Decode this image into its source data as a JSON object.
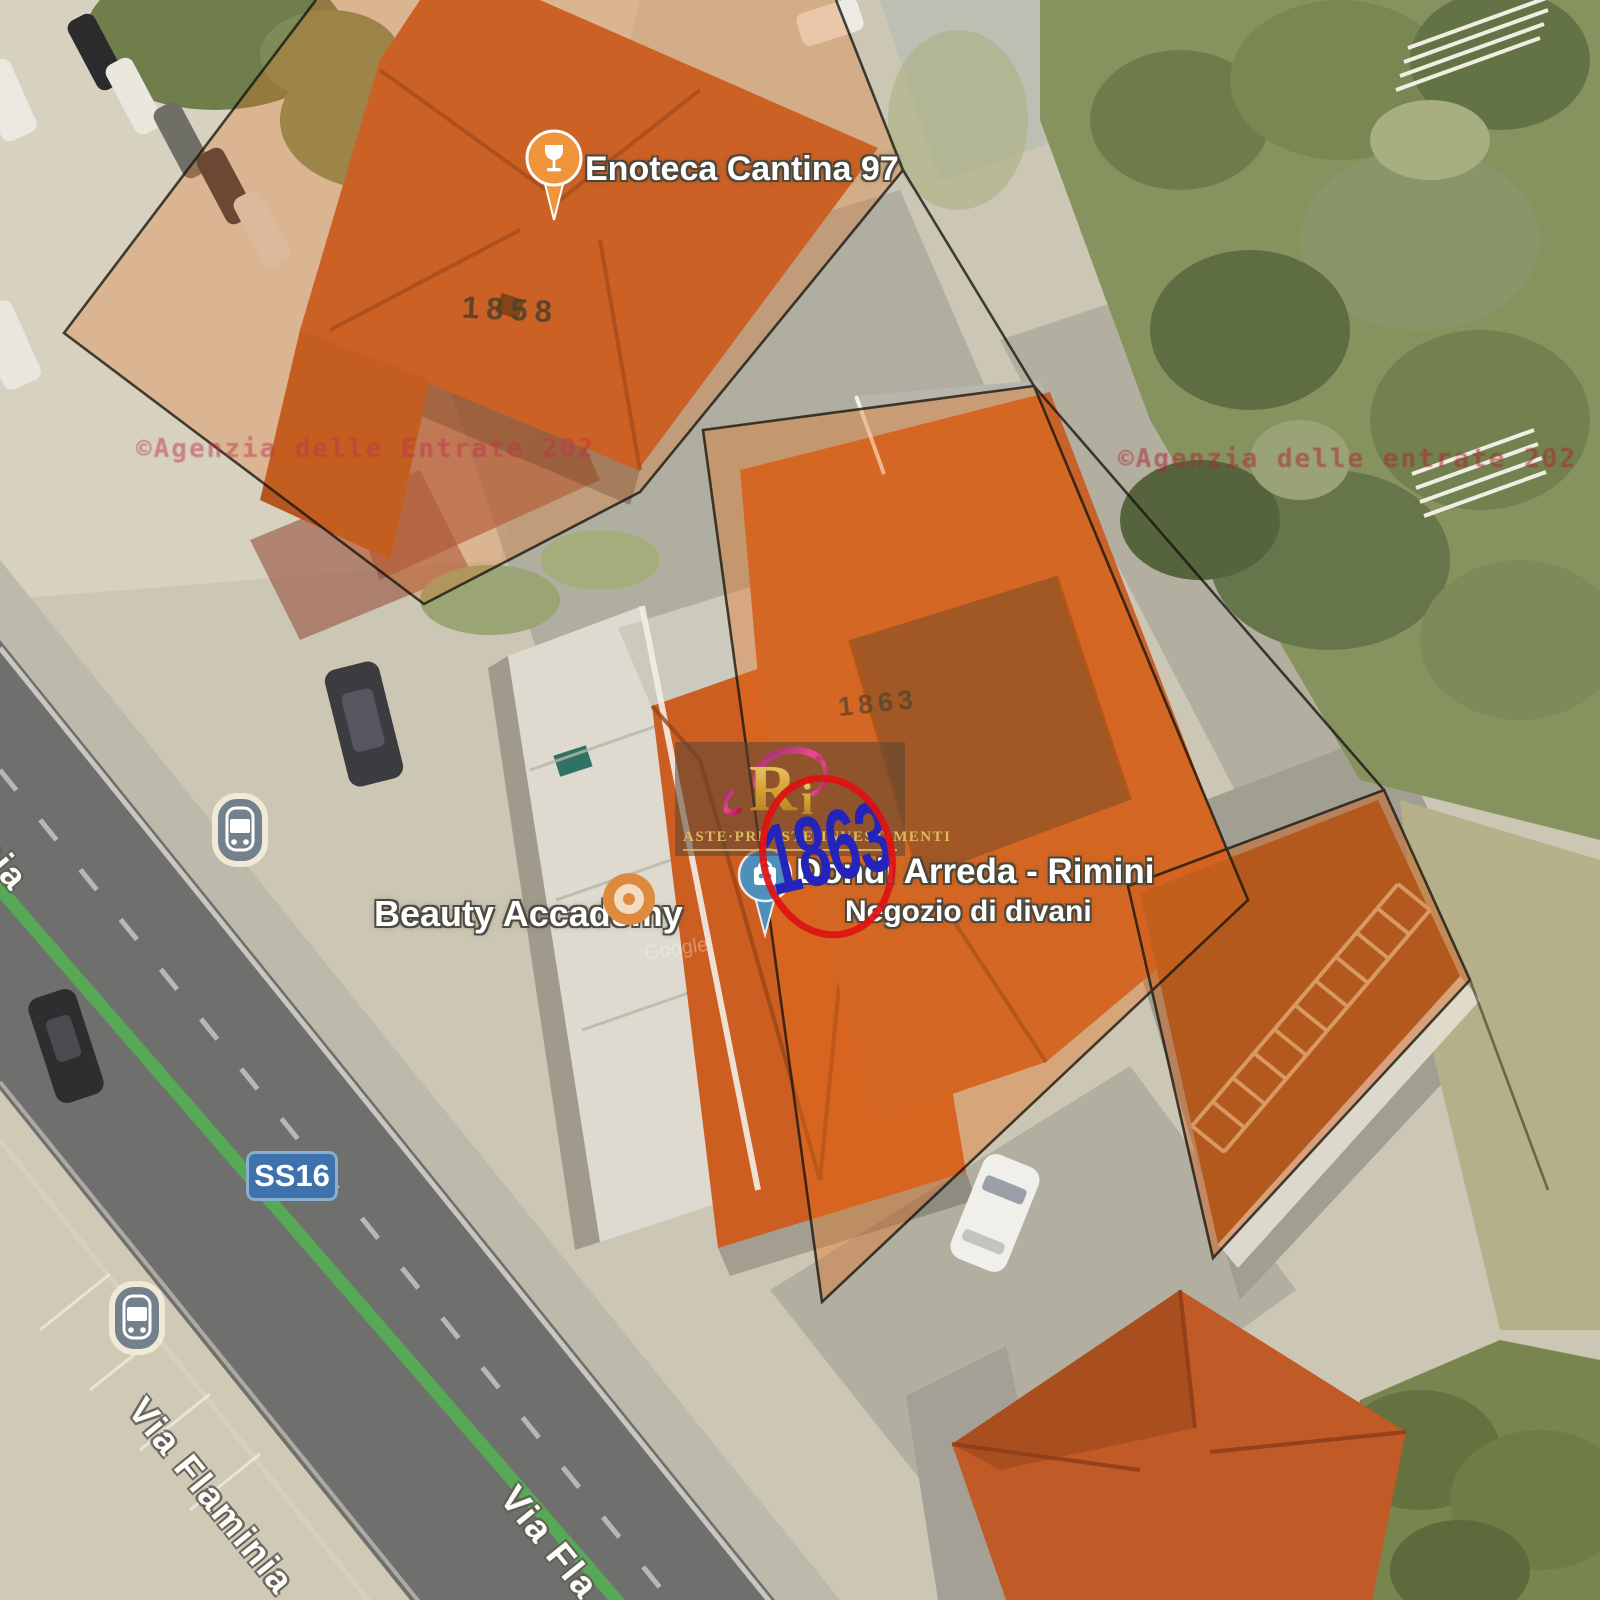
{
  "map": {
    "attribution": "Google",
    "road": {
      "name": "Via Flaminia",
      "name_cut_bottom": "Via Fla",
      "name_cut_left": "inia",
      "route_badge": "SS16"
    },
    "pois": {
      "enoteca": {
        "label": "Enoteca Cantina 97",
        "icon": "wine-glass-pin"
      },
      "beauty": {
        "label": "Beauty Accademy",
        "icon": "poi-dot"
      },
      "dondi": {
        "label": "Dondi Arreda - Rimini",
        "sublabel": "Negozio di divani",
        "icon": "shopping-bag-pin"
      }
    },
    "transit": {
      "icon": "bus-stop"
    }
  },
  "cadastre": {
    "parcel_top": "1858",
    "parcel_main": "1863",
    "agency_left": "©Agenzia delle Entrate 202",
    "agency_right": "©Agenzia delle entrate 202"
  },
  "watermark": {
    "monogram_r": "R",
    "monogram_i": "i",
    "brand": "ASTE·PREASTE·INVESTIMENTI",
    "lot_number": "1863"
  },
  "colors": {
    "highlight_orange": "#E0701C",
    "lot_number_blue": "#2424BB",
    "lot_circle_red": "#DF1212",
    "route_green": "#55AE55",
    "badge_blue": "#3E72AD",
    "poi_orange": "#F0953C",
    "poi_store_blue": "#4E8FBB"
  }
}
